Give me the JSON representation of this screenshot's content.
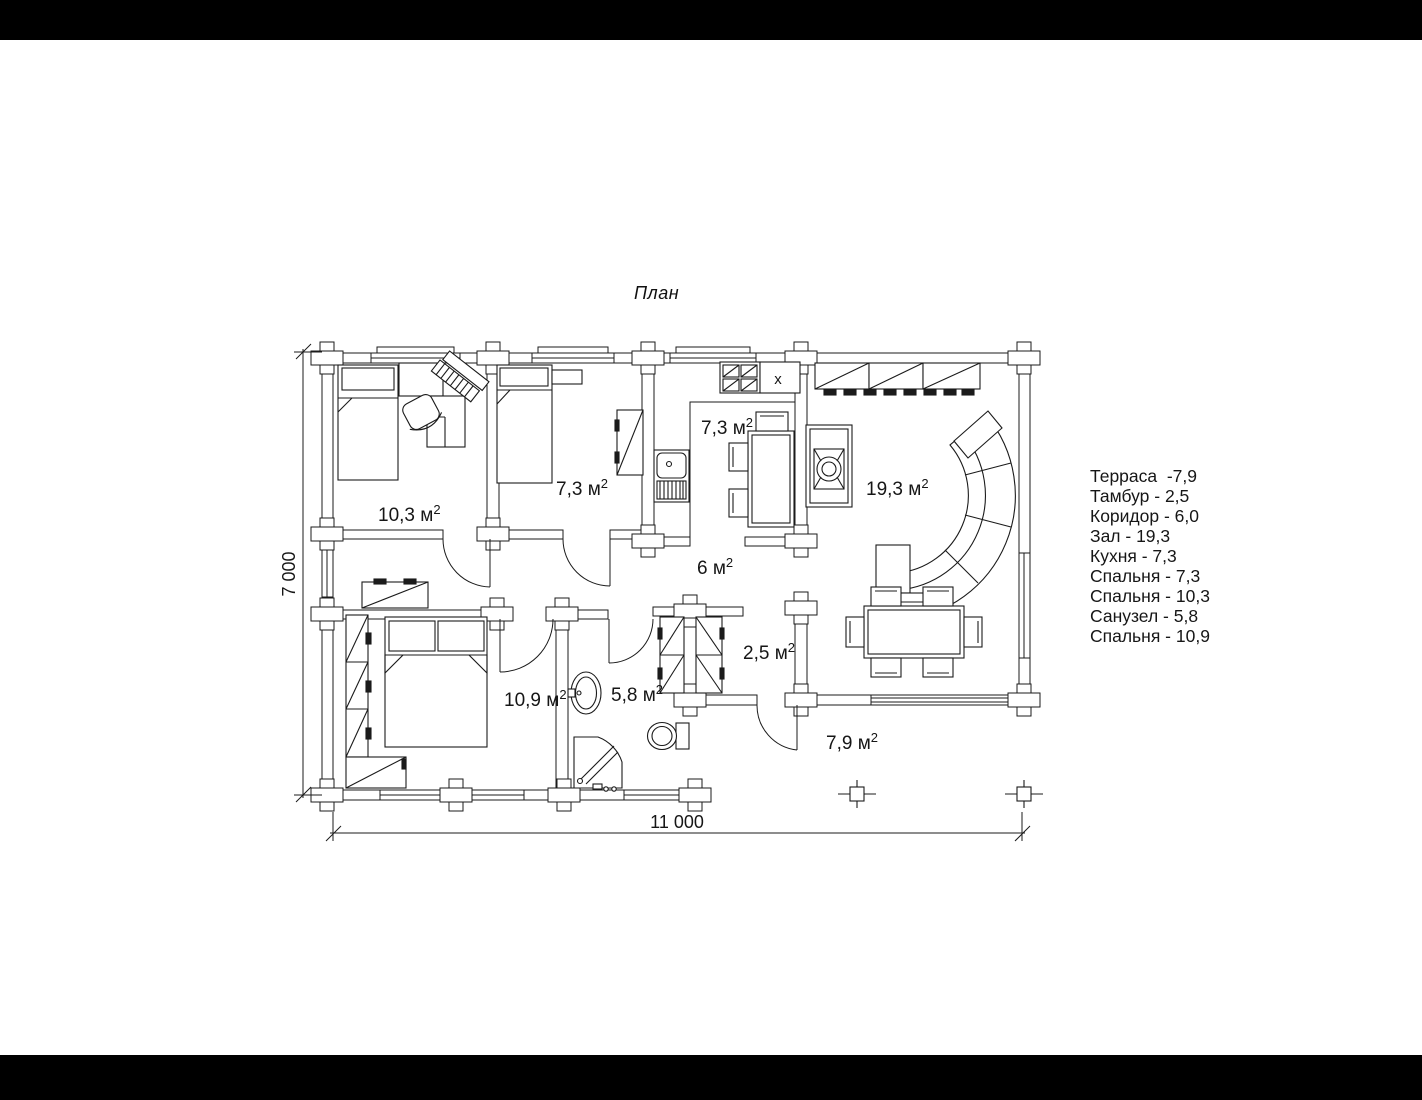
{
  "title": "План",
  "legend": {
    "items": [
      "Терраса  -7,9",
      "Тамбур - 2,5",
      "Коридор - 6,0",
      "Зал - 19,3",
      "Кухня - 7,3",
      "Спальня - 7,3",
      "Спальня - 10,3",
      "Санузел - 5,8",
      "Спальня - 10,9"
    ]
  },
  "dimensions": {
    "width_label": "11 000",
    "height_label": "7 000"
  },
  "kitchen_marker": "x",
  "room_labels": [
    {
      "name": "bedroom-10-3",
      "base": "10,3 м",
      "sup": "2",
      "x": 378,
      "y": 521
    },
    {
      "name": "bedroom-7-3",
      "base": "7,3 м",
      "sup": "2",
      "x": 556,
      "y": 495
    },
    {
      "name": "kitchen-7-3",
      "base": "7,3 м",
      "sup": "2",
      "x": 701,
      "y": 434
    },
    {
      "name": "hall-19-3",
      "base": "19,3 м",
      "sup": "2",
      "x": 866,
      "y": 495
    },
    {
      "name": "corridor-6",
      "base": "6 м",
      "sup": "2",
      "x": 697,
      "y": 574
    },
    {
      "name": "tambour-2-5",
      "base": "2,5 м",
      "sup": "2",
      "x": 743,
      "y": 659
    },
    {
      "name": "bathroom-5-8",
      "base": "5,8 м",
      "sup": "2",
      "x": 611,
      "y": 701
    },
    {
      "name": "bedroom-10-9",
      "base": "10,9 м",
      "sup": "2",
      "x": 504,
      "y": 706
    },
    {
      "name": "terrace-7-9",
      "base": "7,9 м",
      "sup": "2",
      "x": 826,
      "y": 749
    }
  ],
  "colors": {
    "line": "#1b1b1b",
    "background": "#ffffff",
    "letterbox": "#000000"
  }
}
